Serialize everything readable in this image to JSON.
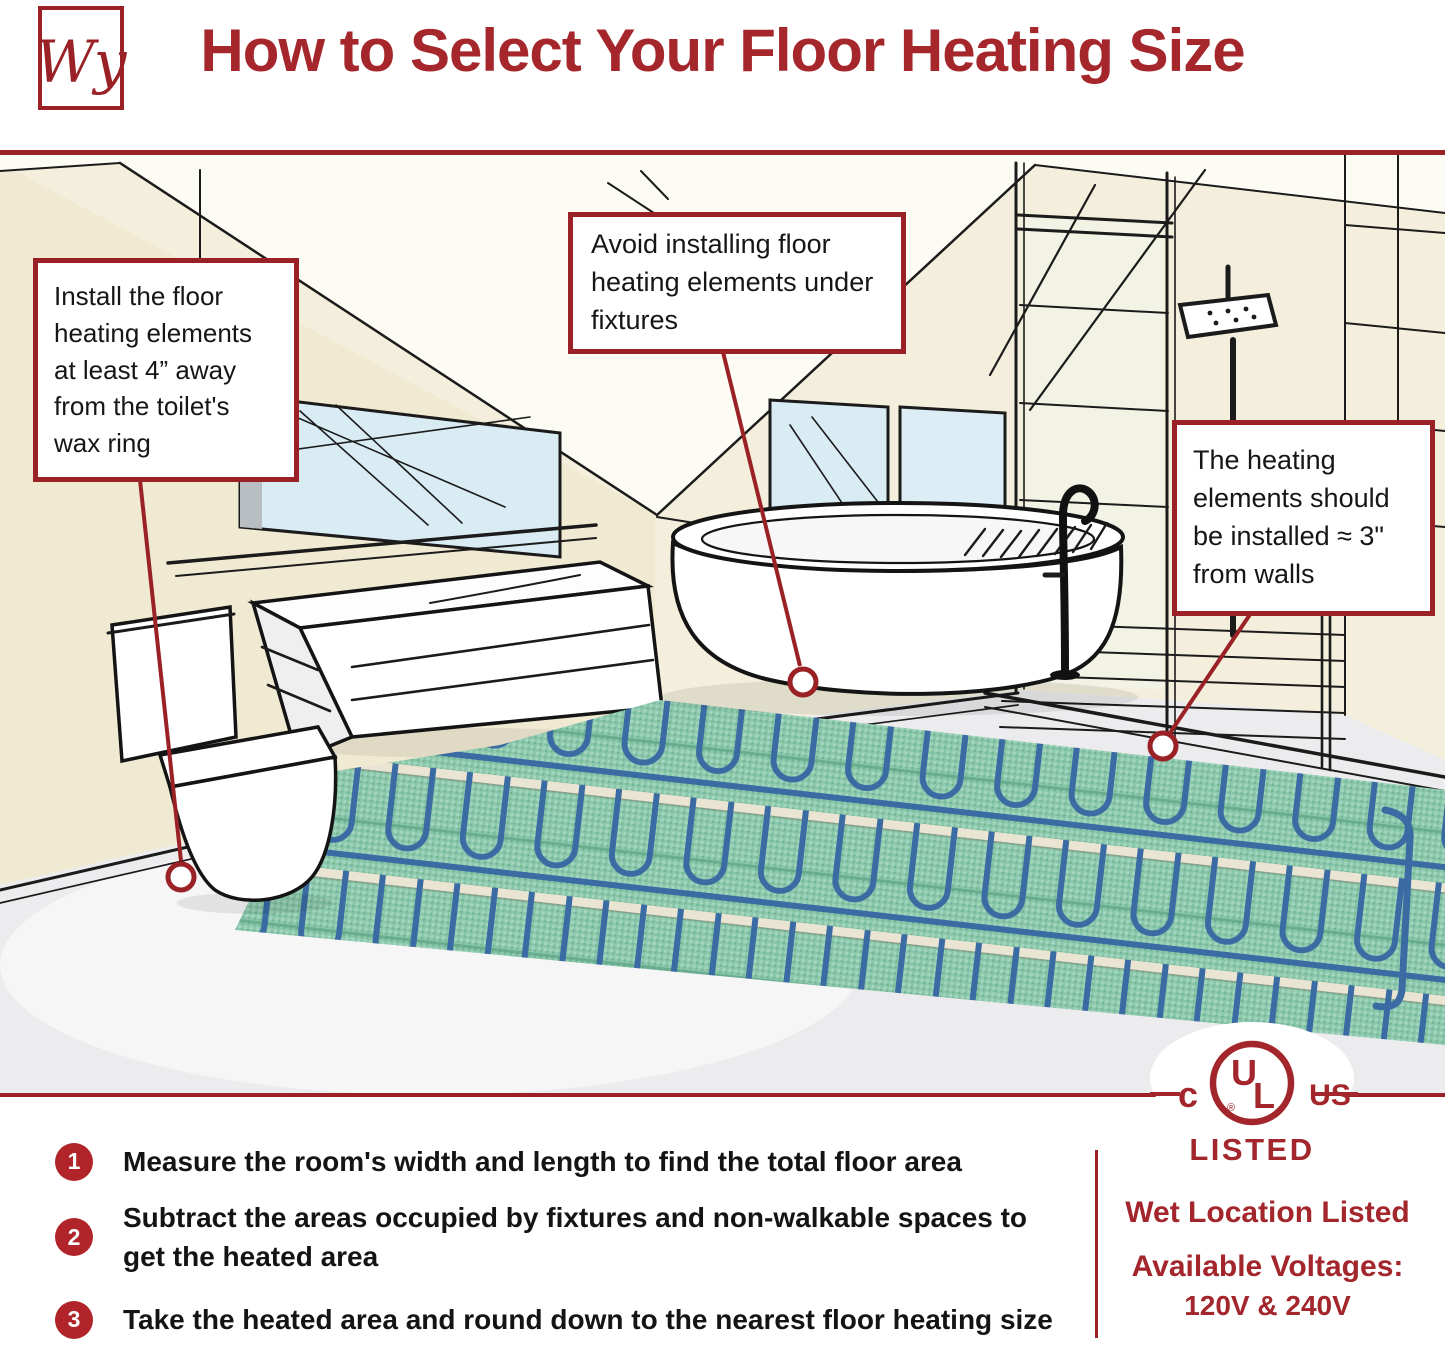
{
  "header": {
    "logo": "Wy",
    "title": "How to Select Your Floor Heating Size"
  },
  "callouts": {
    "toilet": "Install the floor heating elements at least 4” away from the toilet's wax ring",
    "fixtures": "Avoid installing floor heating elements under fixtures",
    "walls": "The heating elements should be installed ≈ 3\" from walls"
  },
  "steps": [
    {
      "number": "1",
      "text": "Measure the room's width and length to find the total floor area"
    },
    {
      "number": "2",
      "text": "Subtract the areas occupied by fixtures and non-walkable spaces to get the heated area"
    },
    {
      "number": "3",
      "text": "Take the heated area and round down to the nearest floor heating size"
    }
  ],
  "certification": {
    "c_mark": "c",
    "u_letter": "U",
    "l_letter": "L",
    "registered": "®",
    "us_mark": "US",
    "listed": "LISTED"
  },
  "footer": {
    "wet_location": "Wet Location Listed",
    "voltages_label": "Available Voltages:",
    "voltages_value": "120V & 240V"
  },
  "colors": {
    "brand_red": "#A5272C",
    "rule_red": "#9A2227",
    "step_badge_red": "#B0242A",
    "mat_green": "#8AC7AB",
    "cable_blue": "#3A6BA3",
    "glass_blue": "#D9EBF3",
    "wall_cream": "#F4EFDC"
  }
}
